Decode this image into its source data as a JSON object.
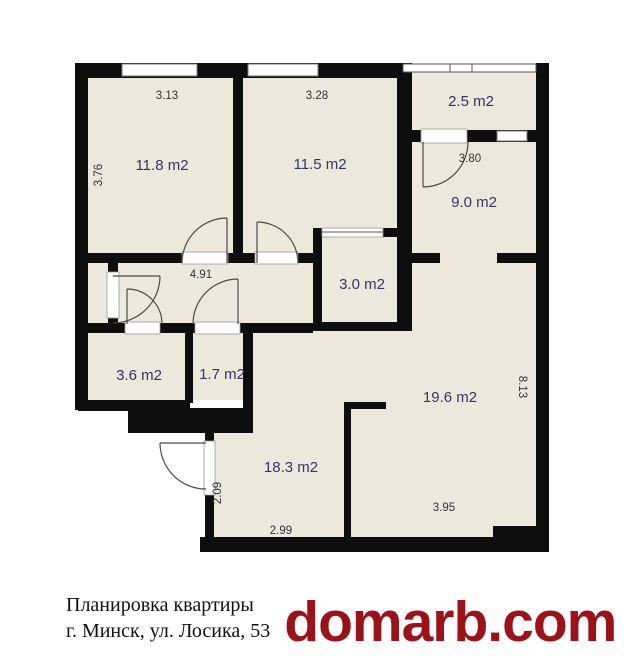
{
  "plan": {
    "rooms": [
      {
        "label": "11.8 m2"
      },
      {
        "label": "11.5 m2"
      },
      {
        "label": "2.5 m2"
      },
      {
        "label": "9.0 m2"
      },
      {
        "label": "3.0 m2"
      },
      {
        "label": "3.6 m2"
      },
      {
        "label": "1.7 m2"
      },
      {
        "label": "19.6 m2"
      },
      {
        "label": "18.3 m2"
      }
    ],
    "dimensions": [
      {
        "label": "3.13"
      },
      {
        "label": "3.28"
      },
      {
        "label": "3.76"
      },
      {
        "label": "3.80"
      },
      {
        "label": "4.91"
      },
      {
        "label": "8.13"
      },
      {
        "label": "2.09"
      },
      {
        "label": "2.99"
      },
      {
        "label": "3.95"
      }
    ],
    "colors": {
      "wall": "#0e0e0e",
      "room_fill": "#ece8db",
      "room_label": "#35336a",
      "dim_label": "#33333c",
      "watermark": "#9c1217"
    }
  },
  "footer": {
    "title": "Планировка квартиры",
    "address": "г. Минск, ул. Лосика, 53",
    "watermark": "domarb.com"
  }
}
